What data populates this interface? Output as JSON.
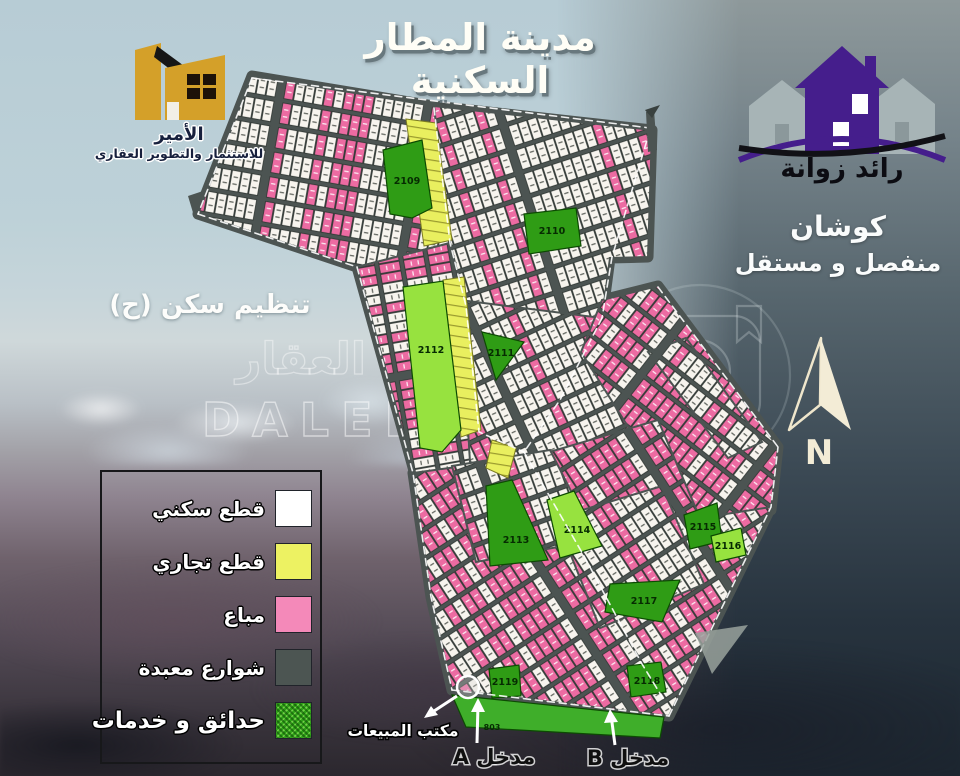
{
  "poster": {
    "title": "مدينة المطار السكنية",
    "zone_note": "تنظيم سكن (ح)",
    "deed_note": {
      "line1": "كوشان",
      "line2": "منفصل و مستقل"
    },
    "compass_label": "N"
  },
  "logo_amir": {
    "name": "الأمير",
    "tagline": "للاستثمار والتطوير العقاري"
  },
  "logo_raed": {
    "name": "رائد زوانة"
  },
  "legend": {
    "items": [
      {
        "label": "قطع سكني",
        "color": "#ffffff"
      },
      {
        "label": "قطع تجاري",
        "color": "#edf262"
      },
      {
        "label": "مباع",
        "color": "#f489b9"
      },
      {
        "label": "شوارع معبدة",
        "color": "#4c5552"
      },
      {
        "label": "حدائق و خدمات",
        "color": "#2fa318"
      }
    ]
  },
  "map": {
    "blocks": {
      "b2109": "2109",
      "b2110": "2110",
      "b2111": "2111",
      "b2112": "2112",
      "b2113": "2113",
      "b2114": "2114",
      "b2115": "2115",
      "b2116": "2116",
      "b2117": "2117",
      "b2118": "2118",
      "b2119": "2119",
      "b803": "803"
    },
    "callouts": {
      "sales_office": "مكتب المبيعات",
      "entrance_a": "مدخل A",
      "entrance_b": "مدخل B"
    },
    "colors": {
      "road": "#4c5452",
      "residential": "#f7f4ee",
      "sold": "#ec6ba2",
      "commercial": "#e9ef5f",
      "park_dark": "#2f9c15",
      "park_light": "#97e23f",
      "park_mid": "#3fae2a",
      "plot_border": "#2e3531"
    }
  },
  "watermark": {
    "latin": "DALEEL",
    "arabic": "العقار"
  }
}
